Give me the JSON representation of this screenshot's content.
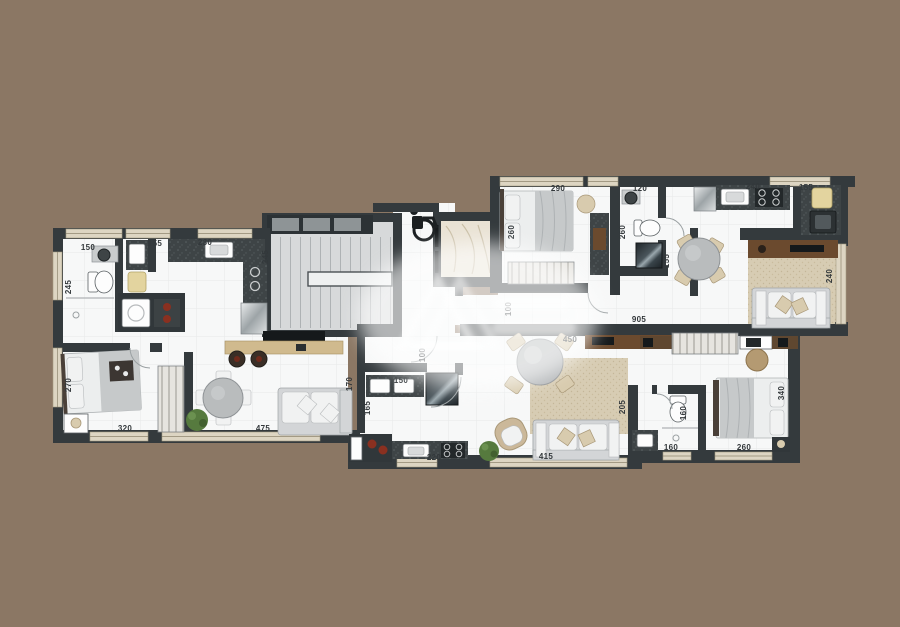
{
  "document": {
    "kind": "residential floor plan (top-view architectural render)",
    "background_color": "#8b7764",
    "wall_color": "#343a3d",
    "floor_color": "#f7f8f8",
    "rug_color": "#d7ccb3",
    "stair_color": "#d7d9da",
    "counter_color": "#3e4446",
    "wood_dark_color": "#6b4a2e",
    "wood_light_color": "#d0ba8e",
    "marble_color": "#e9e2d4",
    "accent_red_color": "#8a3020",
    "plant_color": "#567a3e",
    "label_color": "#33383b"
  },
  "icons": {
    "wheelchair": "wheelchair-accessibility-icon",
    "watermark": "faded-realty-watermark-logo"
  },
  "dimension_labels": [
    {
      "text": "150",
      "x": 88,
      "y": 250,
      "rot": 0
    },
    {
      "text": "155",
      "x": 155,
      "y": 246,
      "rot": 0
    },
    {
      "text": "230",
      "x": 205,
      "y": 245,
      "rot": 0
    },
    {
      "text": "245",
      "x": 71,
      "y": 287,
      "rot": -90
    },
    {
      "text": "245",
      "x": 268,
      "y": 257,
      "rot": -90
    },
    {
      "text": "290",
      "x": 558,
      "y": 191,
      "rot": 0
    },
    {
      "text": "120",
      "x": 640,
      "y": 191,
      "rot": 0
    },
    {
      "text": "240",
      "x": 753,
      "y": 189,
      "rot": 0
    },
    {
      "text": "155",
      "x": 806,
      "y": 190,
      "rot": 0
    },
    {
      "text": "260",
      "x": 514,
      "y": 232,
      "rot": -90
    },
    {
      "text": "260",
      "x": 625,
      "y": 232,
      "rot": -90
    },
    {
      "text": "155",
      "x": 669,
      "y": 261,
      "rot": -90
    },
    {
      "text": "240",
      "x": 832,
      "y": 276,
      "rot": -90
    },
    {
      "text": "100",
      "x": 511,
      "y": 309,
      "rot": -90
    },
    {
      "text": "905",
      "x": 639,
      "y": 322,
      "rot": 0
    },
    {
      "text": "450",
      "x": 570,
      "y": 342,
      "rot": 0
    },
    {
      "text": "100",
      "x": 425,
      "y": 355,
      "rot": -90
    },
    {
      "text": "170",
      "x": 352,
      "y": 384,
      "rot": -90
    },
    {
      "text": "150",
      "x": 401,
      "y": 383,
      "rot": 0
    },
    {
      "text": "165",
      "x": 370,
      "y": 408,
      "rot": -90
    },
    {
      "text": "220",
      "x": 434,
      "y": 460,
      "rot": 0
    },
    {
      "text": "415",
      "x": 546,
      "y": 459,
      "rot": 0
    },
    {
      "text": "205",
      "x": 625,
      "y": 407,
      "rot": -90
    },
    {
      "text": "160",
      "x": 686,
      "y": 413,
      "rot": -90
    },
    {
      "text": "160",
      "x": 671,
      "y": 450,
      "rot": 0
    },
    {
      "text": "260",
      "x": 744,
      "y": 450,
      "rot": 0
    },
    {
      "text": "340",
      "x": 784,
      "y": 393,
      "rot": -90
    },
    {
      "text": "270",
      "x": 71,
      "y": 385,
      "rot": -90
    },
    {
      "text": "320",
      "x": 125,
      "y": 431,
      "rot": 0
    },
    {
      "text": "475",
      "x": 263,
      "y": 431,
      "rot": 0
    }
  ]
}
